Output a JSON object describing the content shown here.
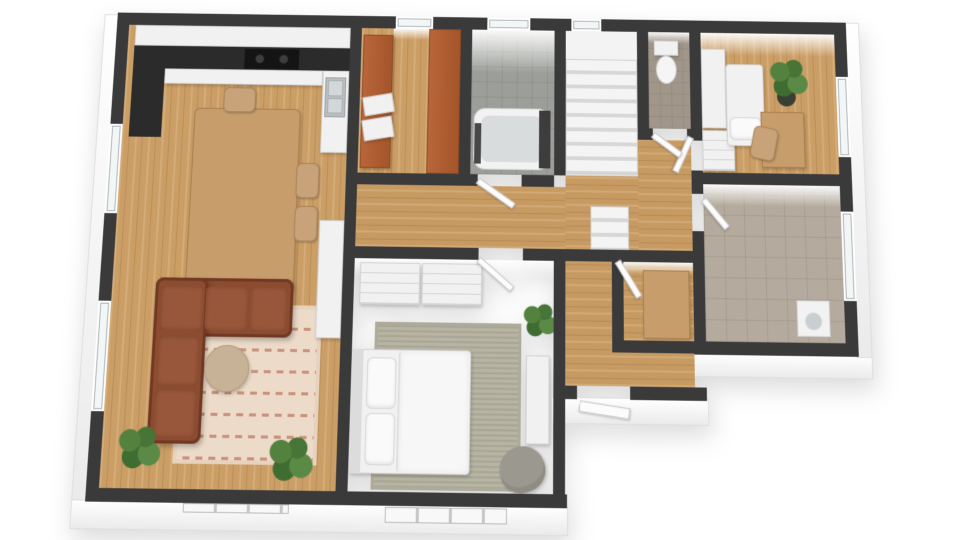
{
  "meta": {
    "description": "3D rendered top-down floor plan of an apartment, no text labels visible",
    "background": "#ffffff"
  },
  "palette": {
    "wall_cut": "#3a3a3a",
    "wall_face": "#f5f5f5",
    "wood_floor": "#cb9e66",
    "bath_tile": "#9c9e9a",
    "utility_tile": "#b4aa9d",
    "wc_floor": "#a1968a",
    "sofa_brown": "#8d4b30",
    "living_rug": "#eddbc9",
    "bedroom_rug": "#b7b4a3",
    "wardrobe_orange": "#b8663a",
    "counter_dark": "#2b2b2b",
    "furniture_wood": "#c79d6b",
    "furniture_white": "#f1f1f1",
    "plant_green": "#4a7a38"
  },
  "rooms": [
    {
      "name": "open-kitchen-dining-living",
      "floor": "wood"
    },
    {
      "name": "closet-pantry",
      "floor": "wood"
    },
    {
      "name": "bathroom",
      "floor": "grey-tile"
    },
    {
      "name": "staircase",
      "floor": "white-steps"
    },
    {
      "name": "wc",
      "floor": "brown-tile"
    },
    {
      "name": "bedroom-small",
      "floor": "wood"
    },
    {
      "name": "utility-room",
      "floor": "beige-tile"
    },
    {
      "name": "master-bedroom",
      "floor": "wood"
    },
    {
      "name": "hallway",
      "floor": "wood"
    }
  ],
  "elements": [
    {
      "name": "exterior-face-west",
      "cls": "wallface",
      "rect": [
        -14,
        2,
        15,
        492
      ]
    },
    {
      "name": "exterior-face-south",
      "cls": "wallface",
      "rect": [
        -14,
        490,
        497,
        28
      ]
    },
    {
      "name": "exterior-face-south-hall",
      "cls": "wallface",
      "rect": [
        466,
        386,
        160,
        26
      ]
    },
    {
      "name": "exterior-face-south-east",
      "cls": "wallface",
      "rect": [
        610,
        341,
        184,
        24
      ]
    },
    {
      "name": "exterior-face-east",
      "cls": "wallface",
      "rect": [
        778,
        0,
        16,
        344
      ]
    },
    {
      "name": "floor-kitchen-living",
      "cls": "wood-v",
      "rect": [
        13,
        13,
        237,
        466
      ]
    },
    {
      "name": "floor-closet",
      "cls": "wood-v",
      "rect": [
        262,
        13,
        106,
        152
      ]
    },
    {
      "name": "floor-bathroom",
      "cls": "tile-grey",
      "rect": [
        380,
        13,
        88,
        152
      ]
    },
    {
      "name": "floor-stairs-landing",
      "cls": "plain",
      "rect": [
        480,
        13,
        76,
        30
      ],
      "bg": "#f3f3f3"
    },
    {
      "name": "floor-wc",
      "cls": "wcfloor",
      "rect": [
        568,
        13,
        44,
        102
      ]
    },
    {
      "name": "floor-bedroom-small",
      "cls": "wood-v",
      "rect": [
        624,
        13,
        143,
        147
      ]
    },
    {
      "name": "floor-utility",
      "cls": "tile-beige",
      "rect": [
        624,
        172,
        143,
        158
      ]
    },
    {
      "name": "floor-hall-main",
      "cls": "wood-h",
      "rect": [
        262,
        177,
        294,
        63
      ]
    },
    {
      "name": "floor-hall-east",
      "cls": "wood-h",
      "rect": [
        556,
        127,
        56,
        113
      ]
    },
    {
      "name": "floor-stairs-south",
      "cls": "wood-h",
      "rect": [
        480,
        165,
        76,
        87
      ]
    },
    {
      "name": "floor-hall-south",
      "cls": "wood-h",
      "rect": [
        480,
        252,
        48,
        123
      ]
    },
    {
      "name": "floor-nook",
      "cls": "wood-h",
      "rect": [
        540,
        252,
        72,
        78
      ]
    },
    {
      "name": "floor-hall-south-east",
      "cls": "wood-h",
      "rect": [
        528,
        342,
        84,
        33
      ]
    },
    {
      "name": "northwall-face-bathroom",
      "cls": "nface",
      "rect": [
        380,
        13,
        88,
        46
      ]
    },
    {
      "name": "northwall-face-bedroom-small",
      "cls": "nface",
      "rect": [
        624,
        13,
        143,
        24
      ]
    },
    {
      "name": "northwall-face-utility",
      "cls": "nface",
      "rect": [
        624,
        172,
        143,
        22
      ]
    },
    {
      "name": "northwall-face-master",
      "cls": "nface",
      "rect": [
        262,
        252,
        206,
        18
      ]
    },
    {
      "name": "northwall-face-wc",
      "cls": "nface",
      "rect": [
        568,
        13,
        44,
        12
      ]
    },
    {
      "name": "northwall-face-nook",
      "cls": "nface",
      "rect": [
        540,
        252,
        72,
        12
      ]
    },
    {
      "name": "northwall-face-closet",
      "cls": "nface",
      "rect": [
        296,
        13,
        38,
        12
      ]
    },
    {
      "name": "living-rug",
      "cls": "rug1",
      "rect": [
        85,
        300,
        145,
        155
      ]
    },
    {
      "name": "master-bedroom-rug",
      "cls": "rug2",
      "rect": [
        285,
        315,
        150,
        162
      ]
    },
    {
      "name": "kitchen-upper-cabinets",
      "cls": "whitefurn",
      "rect": [
        20,
        13,
        230,
        22
      ]
    },
    {
      "name": "kitchen-counter-left",
      "cls": "dark",
      "rect": [
        20,
        35,
        34,
        96
      ]
    },
    {
      "name": "kitchen-counter-top",
      "cls": "dark",
      "rect": [
        20,
        35,
        230,
        24
      ]
    },
    {
      "name": "kitchen-counter-front",
      "cls": "whitefurn",
      "rect": [
        54,
        59,
        168,
        16
      ]
    },
    {
      "name": "kitchen-cooktop",
      "cls": "cooktop",
      "rect": [
        138,
        37,
        58,
        21
      ]
    },
    {
      "name": "kitchen-sink-cabinet",
      "cls": "whitefurn",
      "rect": [
        222,
        59,
        28,
        86
      ]
    },
    {
      "name": "kitchen-sink",
      "cls": "steel",
      "rect": [
        225,
        66,
        22,
        42
      ]
    },
    {
      "name": "kitchen-sink-basin-1",
      "cls": "sinkb",
      "rect": [
        228,
        69,
        16,
        17
      ]
    },
    {
      "name": "kitchen-sink-basin-2",
      "cls": "sinkb",
      "rect": [
        228,
        88,
        16,
        16
      ]
    },
    {
      "name": "dining-table",
      "cls": "woodfurn",
      "rect": [
        88,
        100,
        112,
        186
      ],
      "r": "6px"
    },
    {
      "name": "dining-chair-north",
      "cls": "chair",
      "rect": [
        118,
        78,
        34,
        26
      ]
    },
    {
      "name": "dining-chair-south",
      "cls": "chair",
      "rect": [
        116,
        286,
        34,
        26
      ]
    },
    {
      "name": "dining-chair-east-1",
      "cls": "chair",
      "rect": [
        198,
        156,
        24,
        36
      ]
    },
    {
      "name": "dining-chair-east-2",
      "cls": "chair",
      "rect": [
        198,
        200,
        24,
        36
      ]
    },
    {
      "name": "sofa-horizontal",
      "cls": "sofa",
      "rect": [
        58,
        274,
        142,
        58
      ]
    },
    {
      "name": "sofa-vertical",
      "cls": "sofa",
      "rect": [
        58,
        274,
        54,
        162
      ]
    },
    {
      "name": "sofa-cushion-1",
      "cls": "cushion",
      "rect": [
        64,
        282,
        44,
        44
      ]
    },
    {
      "name": "sofa-cushion-2",
      "cls": "cushion",
      "rect": [
        110,
        282,
        44,
        44
      ]
    },
    {
      "name": "sofa-cushion-3",
      "cls": "cushion",
      "rect": [
        156,
        282,
        38,
        44
      ]
    },
    {
      "name": "sofa-cushion-4",
      "cls": "cushion",
      "rect": [
        64,
        332,
        42,
        48
      ]
    },
    {
      "name": "sofa-cushion-5",
      "cls": "cushion",
      "rect": [
        64,
        384,
        42,
        46
      ]
    },
    {
      "name": "coffee-table",
      "cls": "round-table",
      "rect": [
        112,
        340,
        46,
        46
      ]
    },
    {
      "name": "living-plant-1",
      "cls": "plant",
      "rect": [
        26,
        416,
        50,
        50
      ]
    },
    {
      "name": "living-plant-2",
      "cls": "plant",
      "rect": [
        178,
        424,
        52,
        52
      ]
    },
    {
      "name": "living-tall-cabinet",
      "cls": "whitefurn",
      "rect": [
        224,
        214,
        26,
        118
      ]
    },
    {
      "name": "master-wardrobe-1",
      "cls": "whitefurn drawers",
      "rect": [
        268,
        256,
        62,
        42
      ]
    },
    {
      "name": "master-wardrobe-2",
      "cls": "whitefurn drawers",
      "rect": [
        332,
        256,
        62,
        42
      ]
    },
    {
      "name": "master-bed-base",
      "cls": "whitefurn",
      "rect": [
        262,
        342,
        122,
        120
      ],
      "r": "4px"
    },
    {
      "name": "master-bed-headboard",
      "cls": "plain",
      "rect": [
        262,
        342,
        12,
        120
      ],
      "bg": "#dcdcdc"
    },
    {
      "name": "master-bed-pillow-1",
      "cls": "pillow",
      "rect": [
        278,
        350,
        30,
        50
      ]
    },
    {
      "name": "master-bed-pillow-2",
      "cls": "pillow",
      "rect": [
        278,
        404,
        30,
        50
      ]
    },
    {
      "name": "master-bed-duvet",
      "cls": "duvet",
      "rect": [
        310,
        344,
        72,
        116
      ]
    },
    {
      "name": "master-sideboard",
      "cls": "whitefurn",
      "rect": [
        440,
        346,
        24,
        86
      ]
    },
    {
      "name": "master-armchair",
      "cls": "armchair",
      "rect": [
        414,
        434,
        46,
        44
      ],
      "rot": -20
    },
    {
      "name": "master-plant",
      "cls": "plant",
      "rect": [
        434,
        292,
        40,
        40
      ]
    },
    {
      "name": "nook-cabinet",
      "cls": "woodfurn",
      "rect": [
        560,
        260,
        48,
        68
      ]
    },
    {
      "name": "bedroom2-wardrobe",
      "cls": "whitefurn",
      "rect": [
        624,
        30,
        26,
        84
      ]
    },
    {
      "name": "bedroom2-dresser",
      "cls": "whitefurn drawers",
      "rect": [
        624,
        116,
        34,
        42
      ]
    },
    {
      "name": "bedroom2-bed",
      "cls": "whitefurn",
      "rect": [
        650,
        46,
        40,
        86
      ],
      "r": "4px"
    },
    {
      "name": "bedroom2-pillow",
      "cls": "pillow",
      "rect": [
        653,
        102,
        34,
        24
      ]
    },
    {
      "name": "bedroom2-plant-pot",
      "cls": "pot",
      "rect": [
        704,
        70,
        20,
        20
      ]
    },
    {
      "name": "bedroom2-plant",
      "cls": "plant",
      "rect": [
        694,
        36,
        46,
        50
      ]
    },
    {
      "name": "bedroom2-desk",
      "cls": "woodfurn",
      "rect": [
        686,
        96,
        46,
        58
      ]
    },
    {
      "name": "bedroom2-chair",
      "cls": "chair",
      "rect": [
        676,
        112,
        26,
        34
      ],
      "rot": 12
    },
    {
      "name": "washing-machine",
      "cls": "washer",
      "rect": [
        718,
        288,
        34,
        36
      ]
    },
    {
      "name": "toilet-tank",
      "cls": "whitefurn",
      "rect": [
        574,
        22,
        26,
        16
      ]
    },
    {
      "name": "toilet-bowl",
      "cls": "toilet",
      "rect": [
        576,
        38,
        22,
        30
      ]
    },
    {
      "name": "bathtub",
      "cls": "tub",
      "rect": [
        383,
        96,
        80,
        64
      ]
    },
    {
      "name": "bathtub-inner",
      "cls": "tubin",
      "rect": [
        391,
        104,
        64,
        48
      ]
    },
    {
      "name": "bath-fixture-left",
      "cls": "plain",
      "rect": [
        384,
        112,
        7,
        42
      ],
      "bg": "#474747"
    },
    {
      "name": "bath-fixture-right",
      "cls": "plain",
      "rect": [
        452,
        98,
        12,
        60
      ],
      "bg": "#3d3d3d"
    },
    {
      "name": "closet-wardrobe-left",
      "cls": "orangefurn",
      "rect": [
        264,
        20,
        32,
        140
      ]
    },
    {
      "name": "closet-wardrobe-right",
      "cls": "orangefurn",
      "rect": [
        334,
        13,
        34,
        152
      ]
    },
    {
      "name": "closet-shelf-1",
      "cls": "whitefurn",
      "rect": [
        266,
        84,
        32,
        20
      ],
      "rot": -10
    },
    {
      "name": "closet-shelf-2",
      "cls": "whitefurn",
      "rect": [
        266,
        108,
        32,
        22
      ],
      "rot": -10
    },
    {
      "name": "stairs-flight",
      "cls": "stairs",
      "rect": [
        480,
        43,
        76,
        120
      ]
    },
    {
      "name": "stairs-lower-steps",
      "cls": "stairs",
      "rect": [
        506,
        196,
        40,
        44
      ]
    },
    {
      "name": "wall-north",
      "cls": "wall",
      "rect": [
        0,
        0,
        780,
        13
      ]
    },
    {
      "name": "wall-west",
      "cls": "wall",
      "rect": [
        0,
        0,
        13,
        492
      ]
    },
    {
      "name": "wall-south-main",
      "cls": "wall",
      "rect": [
        0,
        479,
        482,
        13
      ]
    },
    {
      "name": "wall-east",
      "cls": "wall",
      "rect": [
        767,
        0,
        13,
        343
      ]
    },
    {
      "name": "wall-south-right-block",
      "cls": "wall",
      "rect": [
        612,
        330,
        168,
        13
      ]
    },
    {
      "name": "wall-south-hall-left",
      "cls": "wall",
      "rect": [
        468,
        375,
        24,
        13
      ]
    },
    {
      "name": "wall-south-hall-right",
      "cls": "wall",
      "rect": [
        546,
        375,
        78,
        13
      ]
    },
    {
      "name": "wall-living-divider",
      "cls": "wall",
      "rect": [
        250,
        0,
        12,
        479
      ]
    },
    {
      "name": "wall-closet-bath",
      "cls": "wall",
      "rect": [
        368,
        0,
        12,
        165
      ]
    },
    {
      "name": "wall-bath-stairs",
      "cls": "wall",
      "rect": [
        468,
        0,
        12,
        165
      ]
    },
    {
      "name": "wall-master-hall",
      "cls": "wall",
      "rect": [
        468,
        240,
        12,
        239
      ]
    },
    {
      "name": "wall-stairs-wc",
      "cls": "wall",
      "rect": [
        556,
        0,
        12,
        115
      ]
    },
    {
      "name": "wall-wc-bedroom2",
      "cls": "wall",
      "rect": [
        612,
        0,
        12,
        118
      ]
    },
    {
      "name": "wall-hall-utility-mid",
      "cls": "wall",
      "rect": [
        612,
        158,
        12,
        24
      ]
    },
    {
      "name": "wall-hall-utility-low",
      "cls": "wall",
      "rect": [
        612,
        220,
        12,
        110
      ]
    },
    {
      "name": "wall-nook-west",
      "cls": "wall",
      "rect": [
        528,
        240,
        12,
        102
      ]
    },
    {
      "name": "wall-hallway-north-left",
      "cls": "wall",
      "rect": [
        262,
        165,
        126,
        12
      ]
    },
    {
      "name": "wall-hallway-north-right",
      "cls": "wall",
      "rect": [
        434,
        165,
        34,
        12
      ]
    },
    {
      "name": "wall-wc-south-left",
      "cls": "wall",
      "rect": [
        556,
        115,
        16,
        12
      ]
    },
    {
      "name": "wall-wc-south-right",
      "cls": "wall",
      "rect": [
        608,
        115,
        16,
        12
      ]
    },
    {
      "name": "wall-bedroom2-south",
      "cls": "wall",
      "rect": [
        612,
        160,
        155,
        12
      ]
    },
    {
      "name": "wall-hallway-south-left",
      "cls": "wall",
      "rect": [
        250,
        240,
        140,
        12
      ]
    },
    {
      "name": "wall-hallway-south-right",
      "cls": "wall",
      "rect": [
        436,
        240,
        188,
        12
      ]
    },
    {
      "name": "wall-nook-south",
      "cls": "wall",
      "rect": [
        528,
        330,
        96,
        12
      ]
    },
    {
      "name": "window-west-dining",
      "cls": "win",
      "rect": [
        0,
        118,
        13,
        92
      ]
    },
    {
      "name": "window-west-living",
      "cls": "win",
      "rect": [
        0,
        298,
        13,
        108
      ]
    },
    {
      "name": "window-north-closet",
      "cls": "win",
      "rect": [
        298,
        0,
        40,
        13
      ]
    },
    {
      "name": "window-north-bathroom",
      "cls": "win",
      "rect": [
        396,
        0,
        46,
        13
      ]
    },
    {
      "name": "window-north-stairs",
      "cls": "win",
      "rect": [
        486,
        0,
        32,
        13
      ]
    },
    {
      "name": "window-east-bedroom2",
      "cls": "win",
      "rect": [
        767,
        58,
        13,
        84
      ]
    },
    {
      "name": "window-east-utility",
      "cls": "win",
      "rect": [
        767,
        198,
        13,
        90
      ]
    },
    {
      "name": "window-south-living",
      "cls": "winsill",
      "rect": [
        98,
        492,
        106,
        9
      ]
    },
    {
      "name": "window-south-master",
      "cls": "winsill",
      "rect": [
        300,
        493,
        122,
        15
      ]
    },
    {
      "name": "door-bathroom",
      "cls": "door",
      "rect": [
        388,
        168,
        46,
        7
      ],
      "rot": 34
    },
    {
      "name": "door-master-bedroom",
      "cls": "door",
      "rect": [
        390,
        248,
        46,
        7
      ],
      "rot": 40
    },
    {
      "name": "door-nook",
      "cls": "door",
      "rect": [
        534,
        248,
        42,
        7
      ],
      "rot": 58
    },
    {
      "name": "door-bedroom2",
      "cls": "door",
      "rect": [
        612,
        120,
        40,
        7
      ],
      "rot": 115
    },
    {
      "name": "door-utility",
      "cls": "door",
      "rect": [
        624,
        184,
        38,
        7
      ],
      "rot": 50
    },
    {
      "name": "door-wc",
      "cls": "door",
      "rect": [
        572,
        118,
        36,
        7
      ],
      "rot": 36
    },
    {
      "name": "door-front",
      "cls": "door",
      "rect": [
        494,
        389,
        52,
        11
      ],
      "rot": 8
    }
  ]
}
